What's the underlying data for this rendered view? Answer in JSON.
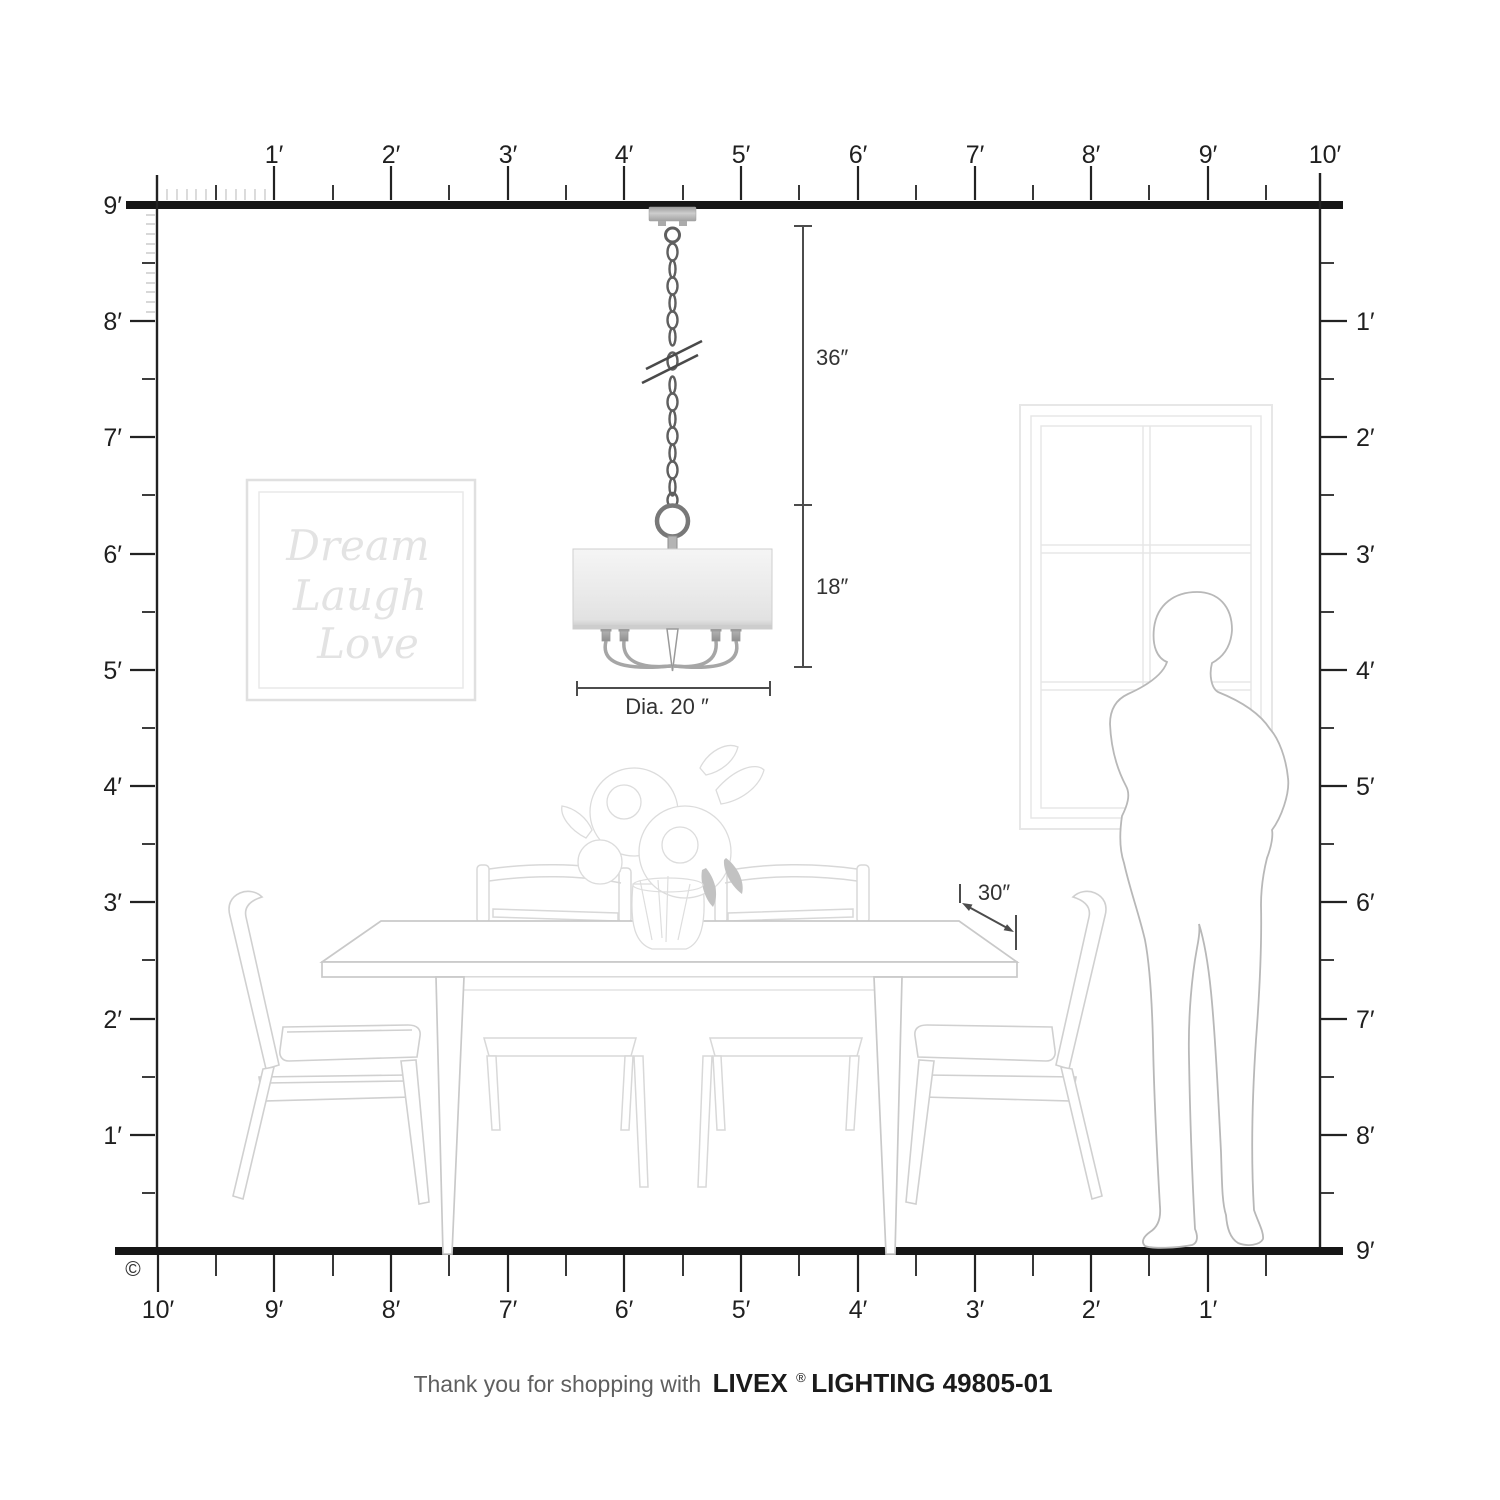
{
  "rulers": {
    "top": {
      "labels": [
        "1′",
        "2′",
        "3′",
        "4′",
        "5′",
        "6′",
        "7′",
        "8′",
        "9′",
        "10′"
      ]
    },
    "left": {
      "labels": [
        "9′",
        "8′",
        "7′",
        "6′",
        "5′",
        "4′",
        "3′",
        "2′",
        "1′"
      ]
    },
    "right": {
      "labels": [
        "1′",
        "2′",
        "3′",
        "4′",
        "5′",
        "6′",
        "7′",
        "8′",
        "9′"
      ]
    },
    "bottom": {
      "labels": [
        "10′",
        "9′",
        "8′",
        "7′",
        "6′",
        "5′",
        "4′",
        "3′",
        "2′",
        "1′"
      ]
    }
  },
  "dimensions": {
    "chain_length": "36″",
    "shade_height": "18″",
    "shade_diameter": "Dia. 20 ″",
    "table_clearance": "30″"
  },
  "wall_art": {
    "line1": "Dream",
    "line2": "Laugh",
    "line3": "Love"
  },
  "footer": {
    "prefix": "Thank you for shopping with",
    "brand": "LIVEX",
    "registered": "®",
    "product": "LIGHTING 49805-01"
  },
  "copyright_symbol": "©",
  "colors": {
    "ruler_line": "#161616",
    "tick": "#222222",
    "inch_tick": "#cccccc",
    "dimension_line": "#4c4c4c",
    "furniture_line": "#d0d0d0",
    "window_line": "#e7e7e7",
    "person_line": "#b8b8b8",
    "fixture_metal": "#5f5f5f",
    "shade_fill": "#ececec"
  }
}
